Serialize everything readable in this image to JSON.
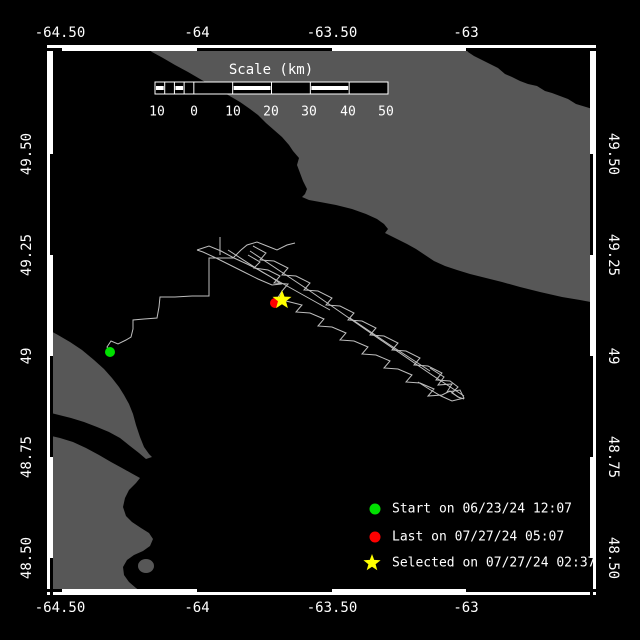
{
  "colors": {
    "background": "#000000",
    "water": "#000000",
    "land": "#575757",
    "track": "#BEBEBE",
    "frame": "#FFFFFF",
    "text": "#FFFFFF",
    "start_marker": "#00E000",
    "last_marker": "#FF0000",
    "selected_marker": "#FFFF00"
  },
  "axes": {
    "top": {
      "y": 33,
      "labels": [
        {
          "text": "-64.50",
          "x": 60
        },
        {
          "text": "-64",
          "x": 197
        },
        {
          "text": "-63.50",
          "x": 332
        },
        {
          "text": "-63",
          "x": 466
        }
      ]
    },
    "bottom": {
      "y": 608,
      "labels": [
        {
          "text": "-64.50",
          "x": 60
        },
        {
          "text": "-64",
          "x": 197
        },
        {
          "text": "-63.50",
          "x": 332
        },
        {
          "text": "-63",
          "x": 466
        }
      ]
    },
    "left": {
      "x": 27,
      "labels": [
        {
          "text": "49.50",
          "y": 154
        },
        {
          "text": "49.25",
          "y": 255
        },
        {
          "text": "49",
          "y": 356
        },
        {
          "text": "48.75",
          "y": 457
        },
        {
          "text": "48.50",
          "y": 558
        }
      ]
    },
    "right": {
      "x": 613,
      "labels": [
        {
          "text": "49.50",
          "y": 154
        },
        {
          "text": "49.25",
          "y": 255
        },
        {
          "text": "49",
          "y": 356
        },
        {
          "text": "48.75",
          "y": 457
        },
        {
          "text": "48.50",
          "y": 558
        }
      ]
    }
  },
  "frame": {
    "outer": {
      "x": 47,
      "y": 45,
      "w": 549,
      "h": 550
    },
    "thickness": 6,
    "black_x_spans": [
      [
        47,
        62
      ],
      [
        197,
        332
      ],
      [
        466,
        596
      ]
    ],
    "black_y_spans": [
      [
        154,
        255
      ],
      [
        356,
        457
      ],
      [
        558,
        595
      ]
    ]
  },
  "scalebar": {
    "title": "Scale (km)",
    "title_x": 271,
    "title_y": 70,
    "bar": {
      "x": 155,
      "y": 82,
      "w": 233,
      "h": 12
    },
    "main_segments": 5,
    "sub_cells": 4,
    "striped_main": [
      1,
      3
    ],
    "striped_sub": [
      0,
      2
    ],
    "labels": [
      {
        "text": "10",
        "x": 157
      },
      {
        "text": "0",
        "x": 194
      },
      {
        "text": "10",
        "x": 233
      },
      {
        "text": "20",
        "x": 271
      },
      {
        "text": "30",
        "x": 309
      },
      {
        "text": "40",
        "x": 348
      },
      {
        "text": "50",
        "x": 386
      }
    ],
    "labels_y": 112
  },
  "legend": {
    "x_marker": 375,
    "x_text": 392,
    "items": [
      {
        "marker": "start-dot",
        "color": "#00E000",
        "label": "Start on 06/23/24 12:07",
        "y": 509
      },
      {
        "marker": "last-dot",
        "color": "#FF0000",
        "label": "Last on 07/27/24 05:07",
        "y": 537
      },
      {
        "marker": "selected-star",
        "color": "#FFFF00",
        "label": "Selected on 07/27/24 02:37",
        "y": 563
      }
    ]
  },
  "map": {
    "interior": {
      "x": 53,
      "y": 51,
      "w": 537,
      "h": 538
    },
    "land": [
      {
        "name": "anticosti-island",
        "points": [
          [
            143,
            45
          ],
          [
            152,
            52
          ],
          [
            163,
            58
          ],
          [
            175,
            65
          ],
          [
            188,
            72
          ],
          [
            200,
            79
          ],
          [
            214,
            87
          ],
          [
            228,
            95
          ],
          [
            240,
            102
          ],
          [
            250,
            109
          ],
          [
            258,
            115
          ],
          [
            266,
            123
          ],
          [
            274,
            130
          ],
          [
            282,
            137
          ],
          [
            289,
            145
          ],
          [
            293,
            151
          ],
          [
            299,
            158
          ],
          [
            297,
            165
          ],
          [
            300,
            173
          ],
          [
            303,
            181
          ],
          [
            307,
            189
          ],
          [
            305,
            194
          ],
          [
            302,
            197
          ],
          [
            309,
            200
          ],
          [
            320,
            202
          ],
          [
            336,
            205
          ],
          [
            352,
            209
          ],
          [
            366,
            214
          ],
          [
            377,
            219
          ],
          [
            384,
            224
          ],
          [
            388,
            229
          ],
          [
            385,
            233
          ],
          [
            391,
            236
          ],
          [
            399,
            240
          ],
          [
            407,
            244
          ],
          [
            416,
            249
          ],
          [
            425,
            255
          ],
          [
            434,
            261
          ],
          [
            445,
            266
          ],
          [
            457,
            270
          ],
          [
            470,
            274
          ],
          [
            486,
            278
          ],
          [
            502,
            282
          ],
          [
            520,
            287
          ],
          [
            540,
            292
          ],
          [
            562,
            297
          ],
          [
            580,
            300
          ],
          [
            596,
            303
          ],
          [
            596,
            110
          ],
          [
            586,
            107
          ],
          [
            576,
            104
          ],
          [
            568,
            99
          ],
          [
            560,
            96
          ],
          [
            552,
            93
          ],
          [
            545,
            91
          ],
          [
            537,
            86
          ],
          [
            528,
            84
          ],
          [
            520,
            81
          ],
          [
            512,
            77
          ],
          [
            505,
            74
          ],
          [
            498,
            68
          ],
          [
            490,
            64
          ],
          [
            482,
            60
          ],
          [
            474,
            56
          ],
          [
            468,
            52
          ],
          [
            463,
            45
          ]
        ]
      },
      {
        "name": "forillon-peninsula",
        "points": [
          [
            47,
            329
          ],
          [
            58,
            335
          ],
          [
            70,
            342
          ],
          [
            82,
            350
          ],
          [
            94,
            360
          ],
          [
            104,
            369
          ],
          [
            112,
            378
          ],
          [
            119,
            387
          ],
          [
            124,
            395
          ],
          [
            129,
            404
          ],
          [
            133,
            414
          ],
          [
            136,
            425
          ],
          [
            140,
            437
          ],
          [
            144,
            447
          ],
          [
            149,
            454
          ],
          [
            152,
            457
          ],
          [
            146,
            459
          ],
          [
            139,
            453
          ],
          [
            130,
            446
          ],
          [
            120,
            438
          ],
          [
            109,
            432
          ],
          [
            97,
            427
          ],
          [
            84,
            422
          ],
          [
            71,
            418
          ],
          [
            59,
            415
          ],
          [
            47,
            412
          ]
        ]
      },
      {
        "name": "gaspe-mainland",
        "points": [
          [
            47,
            435
          ],
          [
            60,
            438
          ],
          [
            73,
            442
          ],
          [
            86,
            448
          ],
          [
            99,
            455
          ],
          [
            111,
            462
          ],
          [
            122,
            468
          ],
          [
            131,
            473
          ],
          [
            140,
            478
          ],
          [
            136,
            483
          ],
          [
            129,
            490
          ],
          [
            125,
            498
          ],
          [
            123,
            507
          ],
          [
            126,
            516
          ],
          [
            132,
            522
          ],
          [
            141,
            528
          ],
          [
            149,
            533
          ],
          [
            153,
            539
          ],
          [
            150,
            546
          ],
          [
            143,
            551
          ],
          [
            134,
            555
          ],
          [
            127,
            560
          ],
          [
            123,
            567
          ],
          [
            124,
            575
          ],
          [
            129,
            582
          ],
          [
            136,
            588
          ],
          [
            143,
            593
          ],
          [
            148,
            597
          ],
          [
            47,
            597
          ]
        ]
      },
      {
        "name": "small-island",
        "ellipse": [
          146,
          566,
          8,
          7
        ]
      }
    ],
    "track_strands": [
      [
        [
          110,
          352
        ],
        [
          107,
          347
        ],
        [
          111,
          341
        ],
        [
          118,
          344
        ],
        [
          126,
          340
        ],
        [
          131,
          337
        ],
        [
          133,
          329
        ],
        [
          133,
          320
        ],
        [
          144,
          319
        ],
        [
          157,
          318
        ],
        [
          159,
          307
        ],
        [
          160,
          297
        ],
        [
          175,
          297
        ],
        [
          192,
          296
        ],
        [
          209,
          296
        ],
        [
          209,
          277
        ],
        [
          209,
          258
        ],
        [
          221,
          258
        ],
        [
          233,
          258
        ],
        [
          241,
          250
        ],
        [
          247,
          245
        ],
        [
          257,
          242
        ],
        [
          267,
          246
        ],
        [
          277,
          250
        ],
        [
          287,
          245
        ],
        [
          295,
          243
        ]
      ],
      [
        [
          250,
          251
        ],
        [
          310,
          291
        ],
        [
          372,
          334
        ],
        [
          432,
          375
        ],
        [
          464,
          396
        ]
      ],
      [
        [
          253,
          246
        ],
        [
          266,
          253
        ],
        [
          260,
          260
        ],
        [
          274,
          261
        ],
        [
          288,
          268
        ],
        [
          282,
          275
        ],
        [
          296,
          276
        ],
        [
          310,
          283
        ],
        [
          304,
          290
        ],
        [
          318,
          291
        ],
        [
          332,
          298
        ],
        [
          326,
          305
        ],
        [
          340,
          306
        ],
        [
          354,
          313
        ],
        [
          348,
          320
        ],
        [
          362,
          321
        ],
        [
          376,
          328
        ],
        [
          370,
          335
        ],
        [
          384,
          336
        ],
        [
          398,
          343
        ],
        [
          392,
          350
        ],
        [
          406,
          351
        ],
        [
          420,
          358
        ],
        [
          414,
          365
        ],
        [
          428,
          366
        ],
        [
          442,
          373
        ],
        [
          436,
          380
        ],
        [
          450,
          381
        ],
        [
          458,
          387
        ],
        [
          452,
          393
        ],
        [
          460,
          398
        ]
      ],
      [
        [
          248,
          255
        ],
        [
          260,
          262
        ],
        [
          254,
          268
        ],
        [
          268,
          270
        ],
        [
          280,
          276
        ],
        [
          274,
          283
        ],
        [
          288,
          284
        ],
        [
          282,
          291
        ],
        [
          277,
          299
        ],
        [
          290,
          302
        ],
        [
          302,
          305
        ],
        [
          296,
          312
        ],
        [
          310,
          313
        ],
        [
          324,
          319
        ],
        [
          318,
          326
        ],
        [
          332,
          327
        ],
        [
          346,
          333
        ],
        [
          340,
          340
        ],
        [
          354,
          341
        ],
        [
          368,
          347
        ],
        [
          362,
          354
        ],
        [
          376,
          355
        ],
        [
          390,
          361
        ],
        [
          384,
          368
        ],
        [
          398,
          369
        ],
        [
          412,
          375
        ],
        [
          406,
          382
        ],
        [
          420,
          383
        ],
        [
          434,
          389
        ],
        [
          428,
          396
        ],
        [
          442,
          395
        ],
        [
          450,
          391
        ],
        [
          458,
          397
        ],
        [
          464,
          399
        ]
      ],
      [
        [
          197,
          250
        ],
        [
          209,
          246
        ],
        [
          221,
          251
        ],
        [
          234,
          258
        ],
        [
          247,
          264
        ],
        [
          259,
          270
        ],
        [
          271,
          277
        ],
        [
          281,
          284
        ],
        [
          272,
          285
        ],
        [
          258,
          279
        ],
        [
          244,
          272
        ],
        [
          230,
          265
        ],
        [
          216,
          258
        ],
        [
          203,
          252
        ],
        [
          197,
          250
        ]
      ],
      [
        [
          220,
          237
        ],
        [
          220,
          255
        ]
      ],
      [
        [
          228,
          250
        ],
        [
          262,
          272
        ],
        [
          296,
          291
        ],
        [
          330,
          310
        ]
      ],
      [
        [
          350,
          318
        ],
        [
          390,
          345
        ],
        [
          430,
          371
        ]
      ],
      [
        [
          430,
          368
        ],
        [
          444,
          377
        ],
        [
          438,
          385
        ],
        [
          452,
          384
        ],
        [
          447,
          392
        ],
        [
          460,
          390
        ],
        [
          464,
          398
        ],
        [
          452,
          401
        ],
        [
          441,
          396
        ],
        [
          429,
          389
        ],
        [
          418,
          382
        ]
      ]
    ],
    "markers": {
      "start": {
        "x": 110,
        "y": 352,
        "r": 5
      },
      "last": {
        "x": 275,
        "y": 303,
        "r": 5
      },
      "selected": {
        "x": 282,
        "y": 300,
        "r": 10
      }
    }
  }
}
